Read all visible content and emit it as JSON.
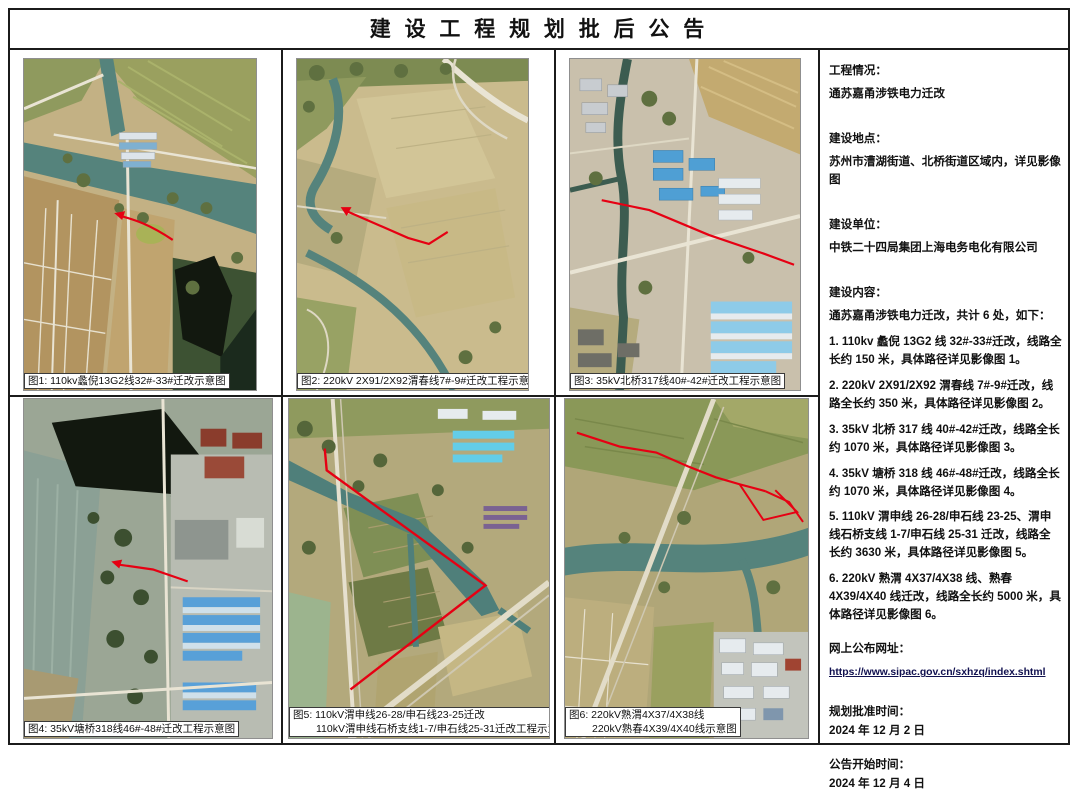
{
  "page_title": "建 设 工 程 规 划 批 后 公 告",
  "figures": {
    "fig1": {
      "caption": "图1: 110kv蠡倪13G2线32#-33#迁改示意图"
    },
    "fig2": {
      "caption": "图2: 220kV 2X91/2X92渭春线7#-9#迁改工程示意图"
    },
    "fig3": {
      "caption": "图3: 35kV北桥317线40#-42#迁改工程示意图"
    },
    "fig4": {
      "caption": "图4: 35kV塘桥318线46#-48#迁改工程示意图"
    },
    "fig5": {
      "caption_line1": "图5: 110kV渭申线26-28/申石线23-25迁改",
      "caption_line2": "110kV渭申线石桥支线1-7/申石线25-31迁改工程示意图"
    },
    "fig6": {
      "caption_line1": "图6: 220kV熟渭4X37/4X38线",
      "caption_line2": "220kV熟春4X39/4X40线示意图"
    }
  },
  "info": {
    "project_label": "工程情况：",
    "project_value": "通苏嘉甬涉铁电力迁改",
    "location_label": "建设地点：",
    "location_value": "苏州市漕湖街道、北桥街道区域内，详见影像图",
    "unit_label": "建设单位：",
    "unit_value": "中铁二十四局集团上海电务电化有限公司",
    "content_label": "建设内容：",
    "content_intro": "通苏嘉甬涉铁电力迁改，共计 6 处，如下：",
    "content_items": [
      "1.  110kv 蠡倪 13G2 线 32#-33#迁改，线路全长约 150 米，具体路径详见影像图 1。",
      "2. 220kV 2X91/2X92 渭春线 7#-9#迁改，线路全长约 350 米，具体路径详见影像图 2。",
      "3. 35kV 北桥 317 线 40#-42#迁改，线路全长约 1070 米，具体路径详见影像图 3。",
      "4. 35kV 塘桥 318 线 46#-48#迁改，线路全长约 1070 米，具体路径详见影像图 4。",
      "5. 110kV 渭申线 26-28/申石线 23-25、渭申线石桥支线 1-7/申石线 25-31 迁改，线路全长约 3630 米，具体路径详见影像图 5。",
      "6.  220kV 熟渭 4X37/4X38 线、熟春 4X39/4X40 线迁改，线路全长约 5000 米，具体路径详见影像图 6。"
    ],
    "website_label": "网上公布网址：",
    "website_url": "https://www.sipac.gov.cn/sxhzq/index.shtml",
    "approval_label": "规划批准时间：",
    "approval_value": "2024 年 12 月 2 日",
    "start_label": "公告开始时间：",
    "start_value": "2024 年 12 月 4 日"
  },
  "colors": {
    "route_red": "#e60013",
    "river_teal": "#55837c"
  }
}
